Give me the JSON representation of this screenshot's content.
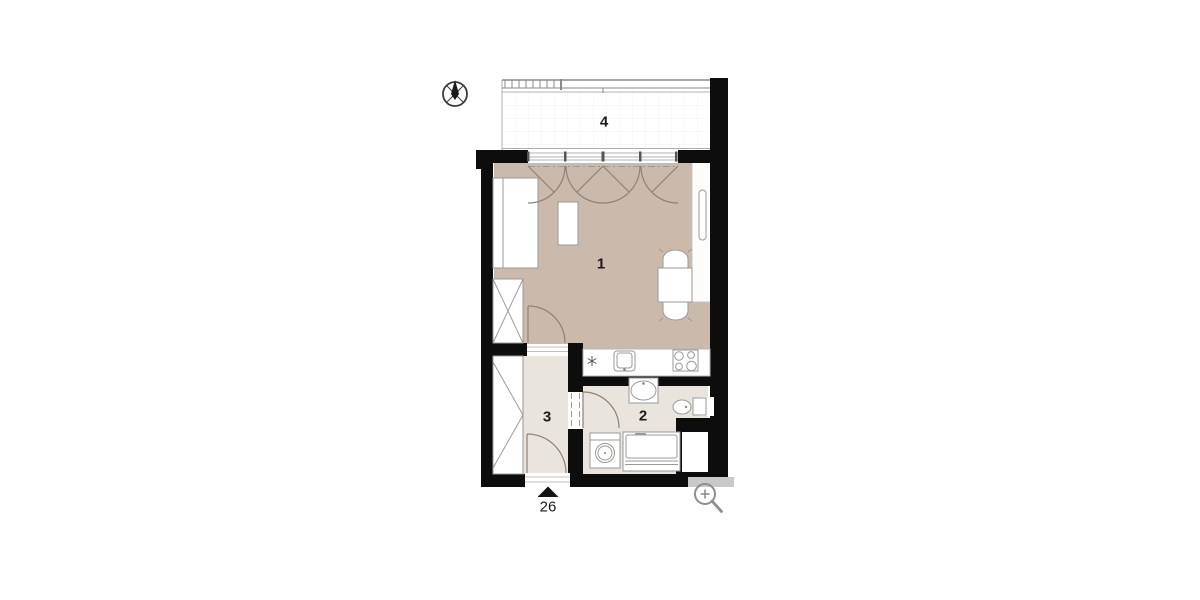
{
  "floor_plan": {
    "room_labels": [
      {
        "id": "room-1",
        "label": "1"
      },
      {
        "id": "room-2",
        "label": "2"
      },
      {
        "id": "room-3",
        "label": "3"
      },
      {
        "id": "room-4-balcony",
        "label": "4"
      }
    ],
    "entry": {
      "number": "26"
    },
    "icons": {
      "compass": "compass-icon",
      "zoom": "zoom-icon"
    },
    "colors": {
      "wall": "#0d0d0d",
      "floor_main": "#cbb9ab",
      "floor_wet": "#e9e5de",
      "balcony_line": "#b0b0b0",
      "grid_line": "#ececec",
      "furniture_stroke": "#999999",
      "door_stroke": "#8d8276",
      "label_color": "#1a1a1a",
      "zoom_icon_gray": "#8e8e8e",
      "corner_bar_gray": "#c9c9c9"
    }
  }
}
